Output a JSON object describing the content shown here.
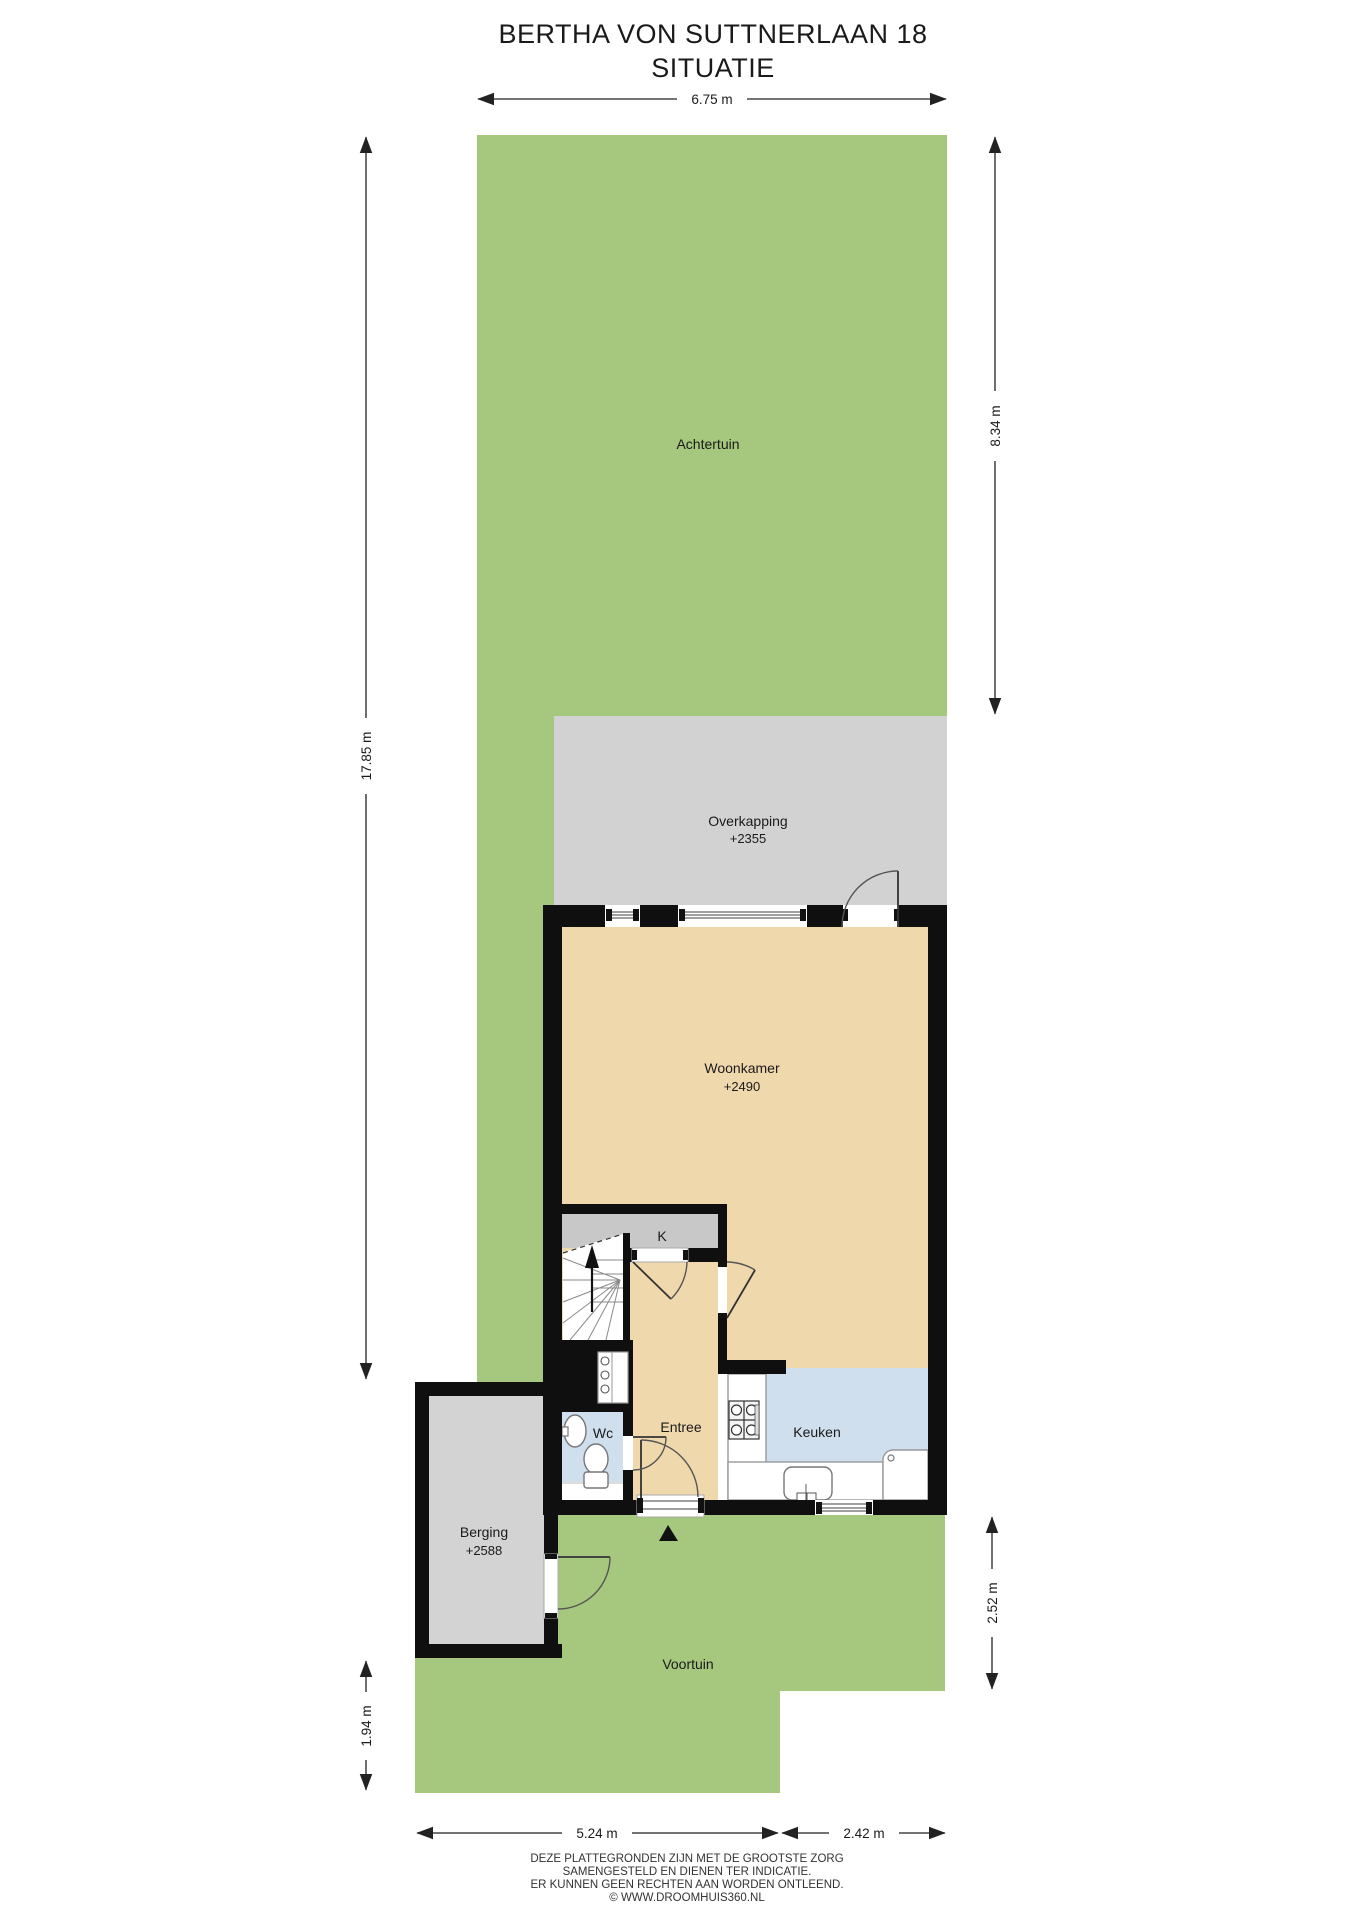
{
  "title": {
    "line1": "BERTHA VON SUTTNERLAAN 18",
    "line2": "SITUATIE"
  },
  "rooms": {
    "achtertuin": {
      "label": "Achtertuin"
    },
    "overkapping": {
      "label": "Overkapping",
      "elevation": "+2355"
    },
    "woonkamer": {
      "label": "Woonkamer",
      "elevation": "+2490"
    },
    "kast": {
      "label": "K"
    },
    "entree": {
      "label": "Entree"
    },
    "wc": {
      "label": "Wc"
    },
    "keuken": {
      "label": "Keuken"
    },
    "berging": {
      "label": "Berging",
      "elevation": "+2588"
    },
    "voortuin": {
      "label": "Voortuin"
    }
  },
  "dimensions": {
    "top_width": "6.75 m",
    "right_upper": "8.34 m",
    "left_total": "17.85 m",
    "left_lower": "1.94 m",
    "right_lower": "2.52 m",
    "bottom_left": "5.24 m",
    "bottom_right": "2.42 m"
  },
  "footer": {
    "line1": "DEZE PLATTEGRONDEN ZIJN MET DE GROOTSTE ZORG",
    "line2": "SAMENGESTELD EN DIENEN TER INDICATIE.",
    "line3": "ER KUNNEN GEEN RECHTEN AAN WORDEN ONTLEEND.",
    "line4": "© WWW.DROOMHUIS360.NL"
  },
  "colors": {
    "garden_green": "#a5c77e",
    "paving_gray": "#d2d2d2",
    "closet_gray": "#c8c8c8",
    "berging_gray": "#d3d3d3",
    "floor_beige": "#f0d8ad",
    "wet_room_blue": "#cfdfee",
    "wall_black": "#0f0f0f"
  }
}
